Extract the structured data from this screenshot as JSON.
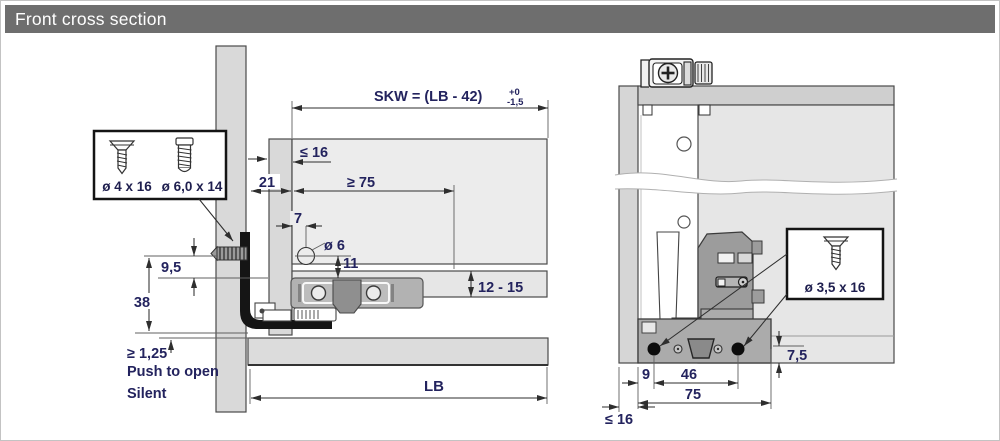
{
  "header": {
    "title": "Front cross section"
  },
  "colors": {
    "header_bg": "#6e6e6e",
    "dimension_text": "#23235e",
    "panel_gray": "#d9d9d9",
    "panel_light": "#ececec",
    "mechanism_gray": "#b2b2b2",
    "black_parts": "#151515"
  },
  "front_view": {
    "dims": {
      "skw_formula": "SKW = (LB - 42)",
      "skw_tolerance_upper": "+0",
      "skw_tolerance_lower": "-1,5",
      "reveal_max": "≤ 16",
      "gap_21": "21",
      "min_75": "≥ 75",
      "hole_offset_7": "7",
      "hole_dia": "ø 6",
      "hole_height_11": "11",
      "dim_9_5": "9,5",
      "dim_38": "38",
      "bottom_thickness": "12 - 15",
      "gap_min": "≥ 1,25",
      "cabinet_width": "LB"
    },
    "features": {
      "line1": "Push to open",
      "line2": "Silent"
    },
    "screw_box": {
      "screw_1_label": "ø 4 x 16",
      "screw_2_label": "ø 6,0 x 14"
    },
    "icons": [
      "countersunk-screw-icon",
      "pan-head-screw-icon",
      "euro-screw-icon"
    ]
  },
  "side_view": {
    "dims": {
      "rail_height": "7,5",
      "screw_offset_9": "9",
      "screw_spacing_46": "46",
      "depth_75": "75",
      "front_thickness": "≤ 16"
    },
    "screw_box": {
      "screw_label": "ø 3,5 x 16"
    },
    "icons": [
      "countersunk-screw-icon",
      "phillips-screw-head-icon"
    ]
  }
}
